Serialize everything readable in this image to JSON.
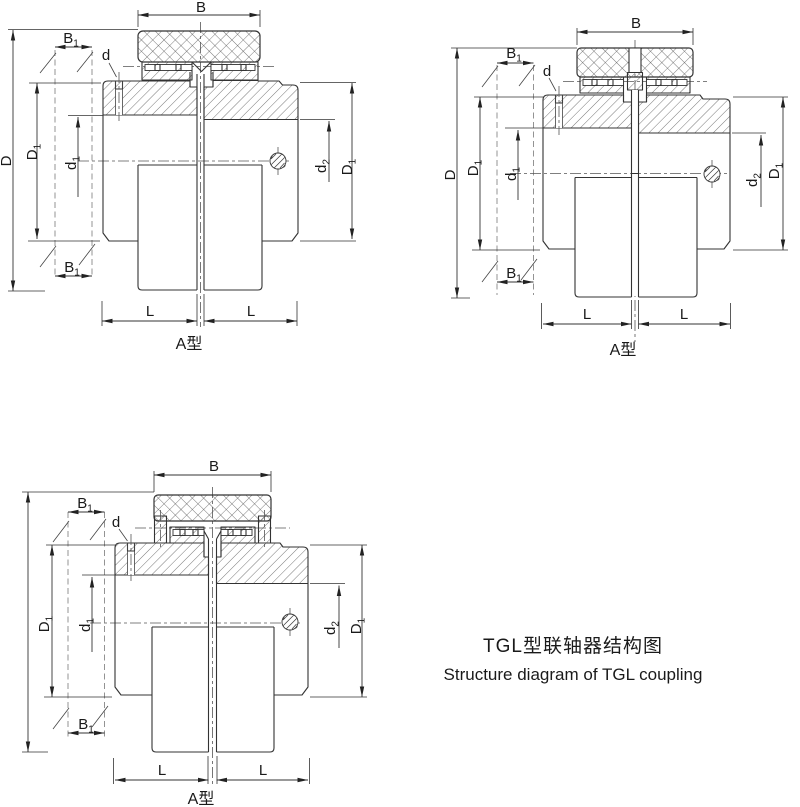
{
  "drawing": {
    "caption_zh": "TGL型联轴器结构图",
    "caption_en": "Structure diagram of TGL coupling"
  },
  "labels": {
    "B": "B",
    "B1_base": "B",
    "B1_sub": "1",
    "d": "d",
    "D": "D",
    "D1_base": "D",
    "D1_sub": "1",
    "d1_base": "d",
    "d1_sub": "1",
    "d2_base": "d",
    "d2_sub": "2",
    "L": "L",
    "variant": "A型"
  }
}
